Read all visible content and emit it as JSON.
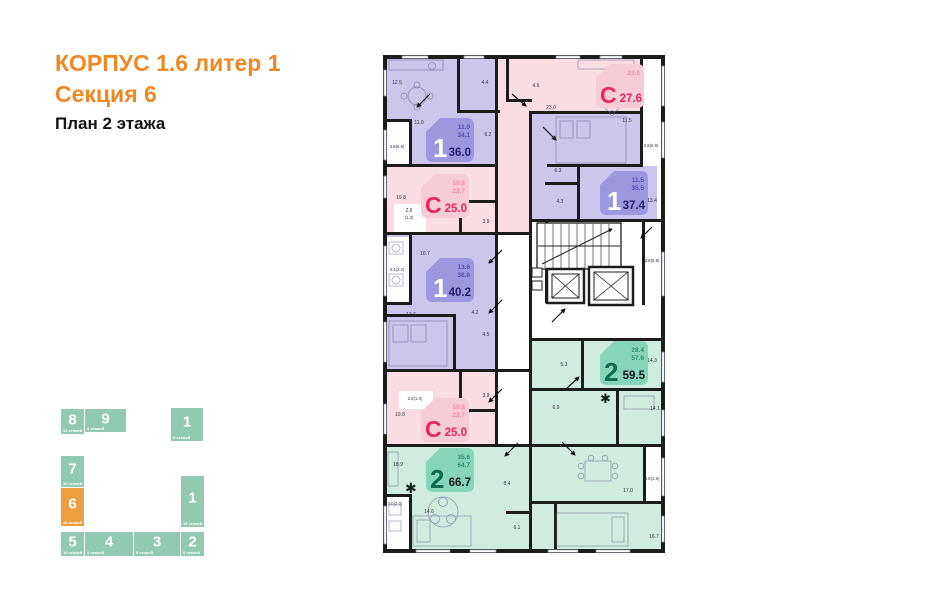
{
  "header": {
    "line1": "КОРПУС 1.6 литер 1",
    "line2": "Секция 6",
    "line3": "План 2 этажа"
  },
  "colors": {
    "accent_orange": "#ef8722",
    "minimap_teal": "#92cab1",
    "minimap_active": "#eb9f3e",
    "purple_fill": "#cac6ec",
    "purple_badge": "#9d97e0",
    "pink_fill": "#f9dde3",
    "pink_badge": "#f6ccd6",
    "green_fill": "#cfecdf",
    "green_badge": "#86d5bb",
    "studio_red": "#e8255c",
    "wall": "#1c1c1c"
  },
  "minimap": {
    "sections": [
      {
        "num": "8",
        "floors": "10 этажей"
      },
      {
        "num": "9",
        "floors": "9 этажей"
      },
      {
        "num": "1",
        "floors": "9 этажей"
      },
      {
        "num": "7",
        "floors": "10 этажей"
      },
      {
        "num": "6",
        "floors": "10 этажей"
      },
      {
        "num": "5",
        "floors": "10 этажей"
      },
      {
        "num": "4",
        "floors": "9 этажей"
      },
      {
        "num": "3",
        "floors": "9 этажей"
      },
      {
        "num": "2",
        "floors": "9 этажей"
      },
      {
        "num": "1",
        "floors": "18 этажей"
      }
    ]
  },
  "plan": {
    "badges": [
      {
        "icon": "1",
        "small1": "11.0",
        "small2": "34.1",
        "area": "36.0"
      },
      {
        "icon": "С",
        "small1": "23.0",
        "small2": "",
        "area": "27.6"
      },
      {
        "icon": "С",
        "small1": "19.8",
        "small2": "23.7",
        "area": "25.0"
      },
      {
        "icon": "1",
        "small1": "11.5",
        "small2": "35.5",
        "area": "37.4"
      },
      {
        "icon": "1",
        "small1": "13.6",
        "small2": "38.0",
        "area": "40.2"
      },
      {
        "icon": "2",
        "small1": "28.4",
        "small2": "57.6",
        "area": "59.5"
      },
      {
        "icon": "С",
        "small1": "19.8",
        "small2": "23.7",
        "area": "25.0"
      },
      {
        "icon": "2",
        "small1": "35.6",
        "small2": "64.7",
        "area": "66.7"
      }
    ],
    "room_labels": [
      "12.5",
      "4.4",
      "11.0",
      "3.8(6.9)",
      "6.2",
      "4.6",
      "23.0",
      "3.8(6.9)",
      "11.5",
      "6.3",
      "4.3",
      "13.4",
      "3.8(6.9)",
      "19.8",
      "2.6",
      "(1.3)",
      "3.9",
      "4.4(2.2)",
      "16.7",
      "13.6",
      "4.2",
      "4.5",
      "2.6(1.3)",
      "19.8",
      "3.9",
      "5.3",
      "14.3",
      "6.9",
      "14.1",
      "18.9",
      "3.8(1.9)",
      "17.0",
      "8.4",
      "4.0(2.0)",
      "14.6",
      "6.1",
      "16.7"
    ],
    "icons": {
      "plant": "✱"
    }
  }
}
